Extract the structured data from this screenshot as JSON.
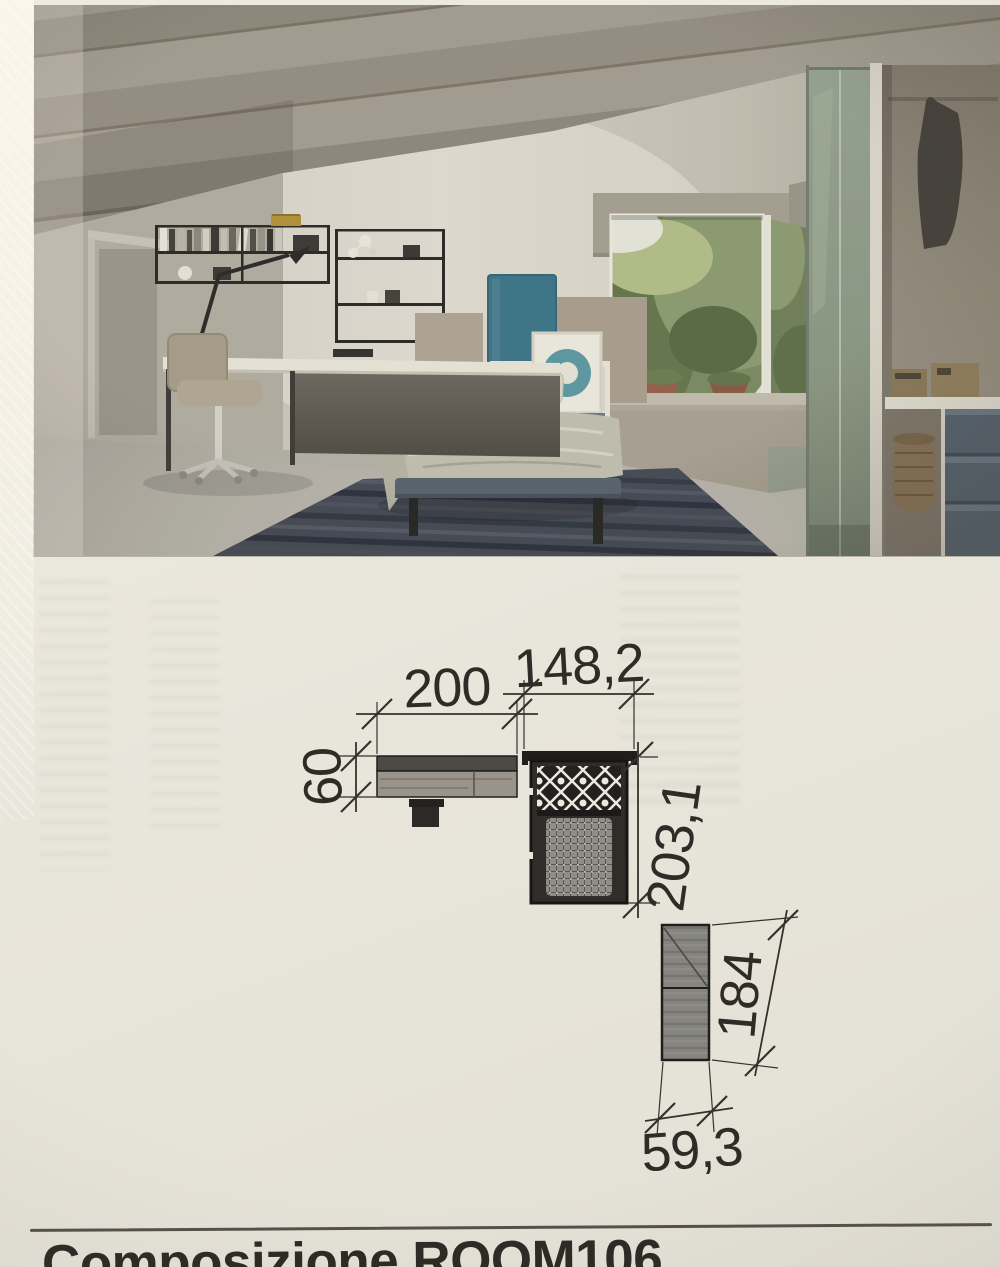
{
  "page": {
    "title": "Composizione ROOM106"
  },
  "plan": {
    "description": "top-view floor plan of composition ROOM106",
    "desk": {
      "width": "200",
      "depth": "60"
    },
    "bed": {
      "width": "148,2",
      "length": "203,1"
    },
    "wardrobe": {
      "height": "184",
      "width": "59,3"
    }
  },
  "colors": {
    "page_background": "#e9e6dc",
    "headboard_teal": "#3c7689",
    "wardrobe_sage": "#93a08c",
    "rug_navy": "#454a57",
    "drawer_blue_grey": "#5b6673",
    "plan_line": "#35322c",
    "title_ink": "#2d2a26"
  }
}
